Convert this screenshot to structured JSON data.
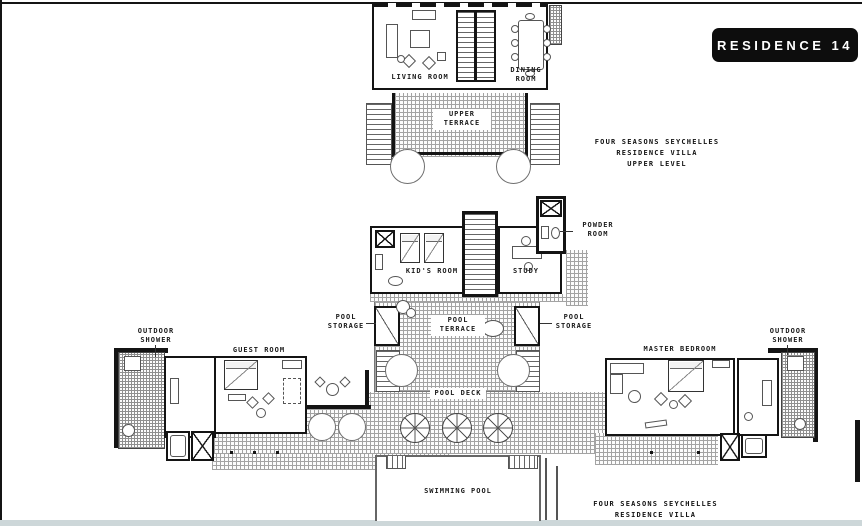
{
  "badge": {
    "label": "RESIDENCE 14"
  },
  "titles": {
    "upper": {
      "line1": "FOUR SEASONS SEYCHELLES",
      "line2": "RESIDENCE VILLA",
      "line3": "UPPER LEVEL"
    },
    "lower": {
      "line1": "FOUR SEASONS SEYCHELLES",
      "line2": "RESIDENCE VILLA"
    }
  },
  "rooms": {
    "living_room": "LIVING ROOM",
    "dining_room": "DINING ROOM",
    "upper_terrace": "UPPER TERRACE",
    "kids_room": "KID'S ROOM",
    "study": "STUDY",
    "powder_room": "POWDER ROOM",
    "pool_storage_left": "POOL STORAGE",
    "pool_storage_right": "POOL STORAGE",
    "pool_terrace": "POOL TERRACE",
    "pool_deck": "POOL DECK",
    "outdoor_shower_left": "OUTDOOR SHOWER",
    "outdoor_shower_right": "OUTDOOR SHOWER",
    "guest_room": "GUEST ROOM",
    "master_bedroom": "MASTER BEDROOM",
    "swimming_pool": "SWIMMING POOL"
  },
  "colors": {
    "wall": "#141414",
    "badge_bg": "#0d0d0d",
    "badge_text": "#ffffff",
    "hatch_line": "#a3a3a3",
    "furniture_line": "#555555",
    "bottom_strip": "#cdd7d9"
  }
}
